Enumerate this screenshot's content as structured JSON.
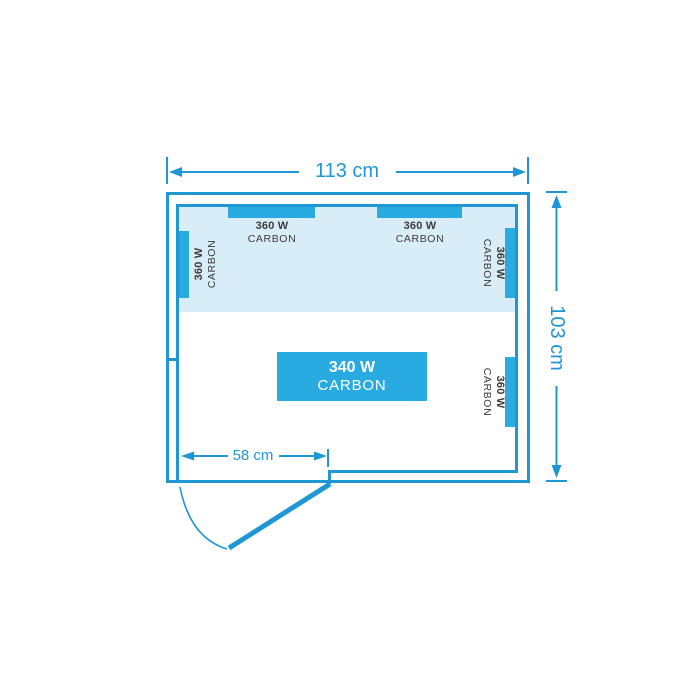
{
  "colors": {
    "line": "#1f97d4",
    "panel": "#29abe2",
    "fill": "#d9edf8",
    "dark": "#3c3c3b",
    "bg": "#ffffff"
  },
  "dimensions": {
    "width_label": "113 cm",
    "height_label": "103 cm",
    "door_label": "58 cm"
  },
  "heaters": {
    "top_left": {
      "watts": "360 W",
      "type": "CARBON"
    },
    "top_right": {
      "watts": "360 W",
      "type": "CARBON"
    },
    "left_wall": {
      "watts": "360 W",
      "type": "CARBON"
    },
    "right_wall_upper": {
      "watts": "360 W",
      "type": "CARBON"
    },
    "right_wall_lower": {
      "watts": "360 W",
      "type": "CARBON"
    },
    "floor": {
      "watts": "340 W",
      "type": "CARBON"
    }
  }
}
